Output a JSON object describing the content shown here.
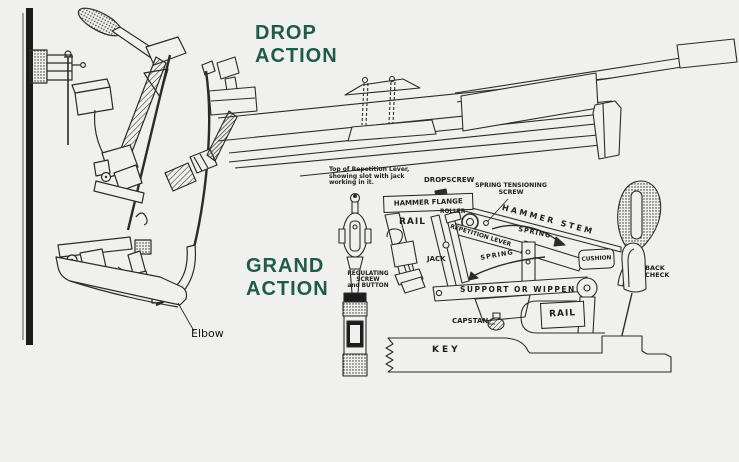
{
  "colors": {
    "background": "#f0f0ee",
    "ink": "#2b2b2b",
    "heading_green": "#1e5b4b"
  },
  "headings": {
    "drop": {
      "line1": "DROP",
      "line2": "ACTION"
    },
    "grand": {
      "line1": "GRAND",
      "line2": "ACTION"
    }
  },
  "drop_diagram": {
    "elbow": "Elbow"
  },
  "grand_diagram": {
    "note": {
      "line1": "Top of Repetition Lever,",
      "line2": "showing slot with jack",
      "line3": "working in it."
    },
    "dropscrew": "DROPSCREW",
    "spring_tensioning": "SPRING TENSIONING SCREW",
    "hammer_flange": "HAMMER FLANGE",
    "roller": "ROLLER",
    "hammer_stem": "HAMMER STEM",
    "rail_upper": "RAIL",
    "repetition_lever": "REPETITION LEVER",
    "spring_upper": "SPRING",
    "jack": "JACK",
    "spring_lower": "SPRING",
    "cushion": "CUSHION",
    "back_check_line1": "BACK",
    "back_check_line2": "CHECK",
    "regulating_line1": "REGULATING",
    "regulating_line2": "SCREW",
    "regulating_line3": "and BUTTON",
    "support": "SUPPORT OR WIPPEN",
    "capstan": "CAPSTAN",
    "rail_lower": "RAIL",
    "key": "KEY"
  }
}
